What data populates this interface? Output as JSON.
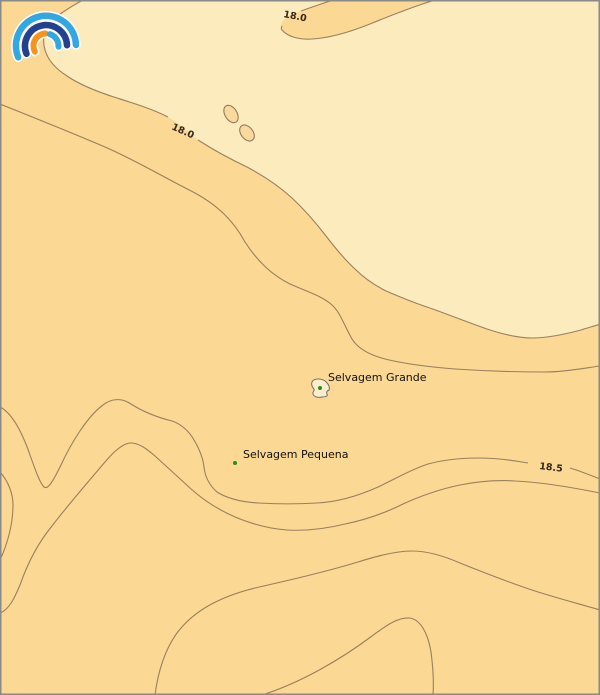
{
  "map_data": {
    "type": "filled-contour-map",
    "contour_levels_labeled": [
      "18.0",
      "18.0",
      "18.5"
    ],
    "zones": [
      {
        "name": "cool-zone",
        "description": "lighter area above the 18.0 isoline",
        "color": "#FCEBBD"
      },
      {
        "name": "warm-zone",
        "description": "darker area below the 18.0 isoline",
        "color": "#FBD893"
      }
    ],
    "islands": [
      "Selvagem Grande",
      "Selvagem Pequena"
    ]
  },
  "contours": {
    "labels": [
      {
        "value": "18.0"
      },
      {
        "value": "18.0"
      },
      {
        "value": "18.5"
      }
    ]
  },
  "places": [
    {
      "label": "Selvagem Grande"
    },
    {
      "label": "Selvagem Pequena"
    }
  ],
  "colors": {
    "zone_cool": "#FCEBBD",
    "zone_warm": "#FBD893",
    "islet_fill": "#FAD99C",
    "contour_line": "#937a5c",
    "island_fill": "#FCEECB",
    "island_outline": "#6f6f6f",
    "marker_green": "#2E8B1F",
    "place_text": "#111111",
    "contour_text": "#33291d",
    "frame": "#8a8a8a",
    "logo_light_blue": "#33A7DF",
    "logo_dark_blue": "#24418E",
    "logo_orange": "#F7941D",
    "logo_halo": "#ffffff"
  },
  "logo": {
    "name": "rainbow-arcs-logo"
  }
}
